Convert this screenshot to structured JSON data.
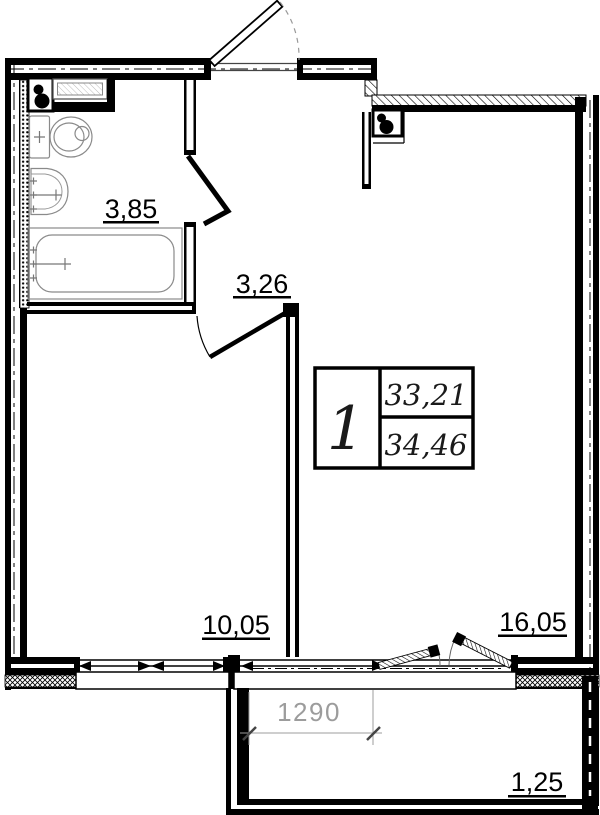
{
  "plan": {
    "type": "apartment floor plan",
    "area_labels": [
      {
        "room": "bathroom",
        "value": "3,85"
      },
      {
        "room": "hallway",
        "value": "3,26"
      },
      {
        "room": "room-left",
        "value": "10,05"
      },
      {
        "room": "room-main",
        "value": "16,05"
      },
      {
        "room": "balcony",
        "value": "1,25"
      }
    ],
    "summary_table": {
      "flat_number": "1",
      "upper_area": "33,21",
      "lower_area": "34,46"
    },
    "dimensions": [
      {
        "id": "balcony-opening-width",
        "value": "1290"
      }
    ],
    "colors": {
      "line": "#000000",
      "dimension_text": "#9c9c9c",
      "fixture_line": "#8a8a8a",
      "background": "#ffffff"
    }
  }
}
